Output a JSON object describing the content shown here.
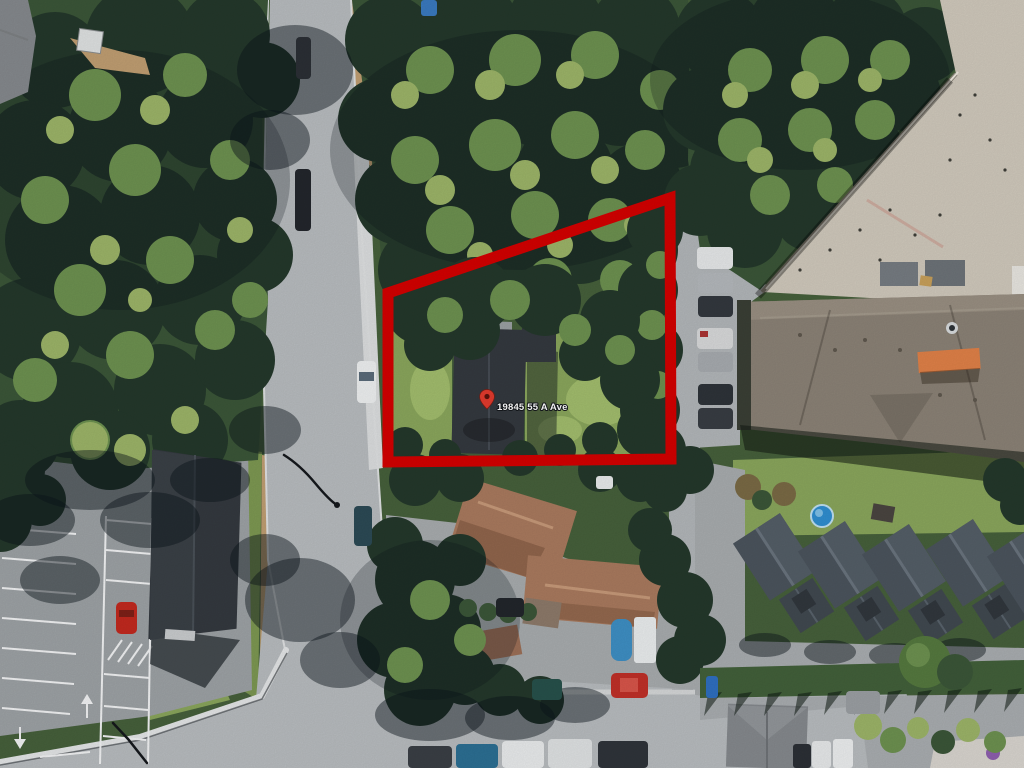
{
  "scene": {
    "description": "Aerial satellite view with highlighted property parcel",
    "address_label": "19845 55 A Ave"
  },
  "colors": {
    "boundary": "#d40000",
    "pin": "#e23b2e",
    "pin-well": "#5c130c",
    "label-text": "#ffffff",
    "label-halo": "#15181c",
    "base": "#46603b",
    "tree-dark": "#24382b",
    "tree-mid": "#3b5638",
    "tree-light": "#6d9150",
    "tree-yellow": "#9cb468",
    "lawn": "#8aa65c",
    "lawn-bright": "#a2bd6d",
    "road": "#b8bcbf",
    "parking": "#9da2a5",
    "sidewalk": "#dcdedf",
    "dirt": "#c09e72",
    "roof-parcel-house": "#34393f",
    "roof-terracotta": "#a97a5e",
    "roof-flat-beige": "#d0c9bc",
    "roof-hip-gray": "#8b8276",
    "roof-townhouse": "#4b545d",
    "roof-gray": "#85898d",
    "awning-orange": "#e08148",
    "pool-blue": "#2f8ed0",
    "car-red": "#c2291f",
    "stripe-white": "#f2f3f4"
  }
}
